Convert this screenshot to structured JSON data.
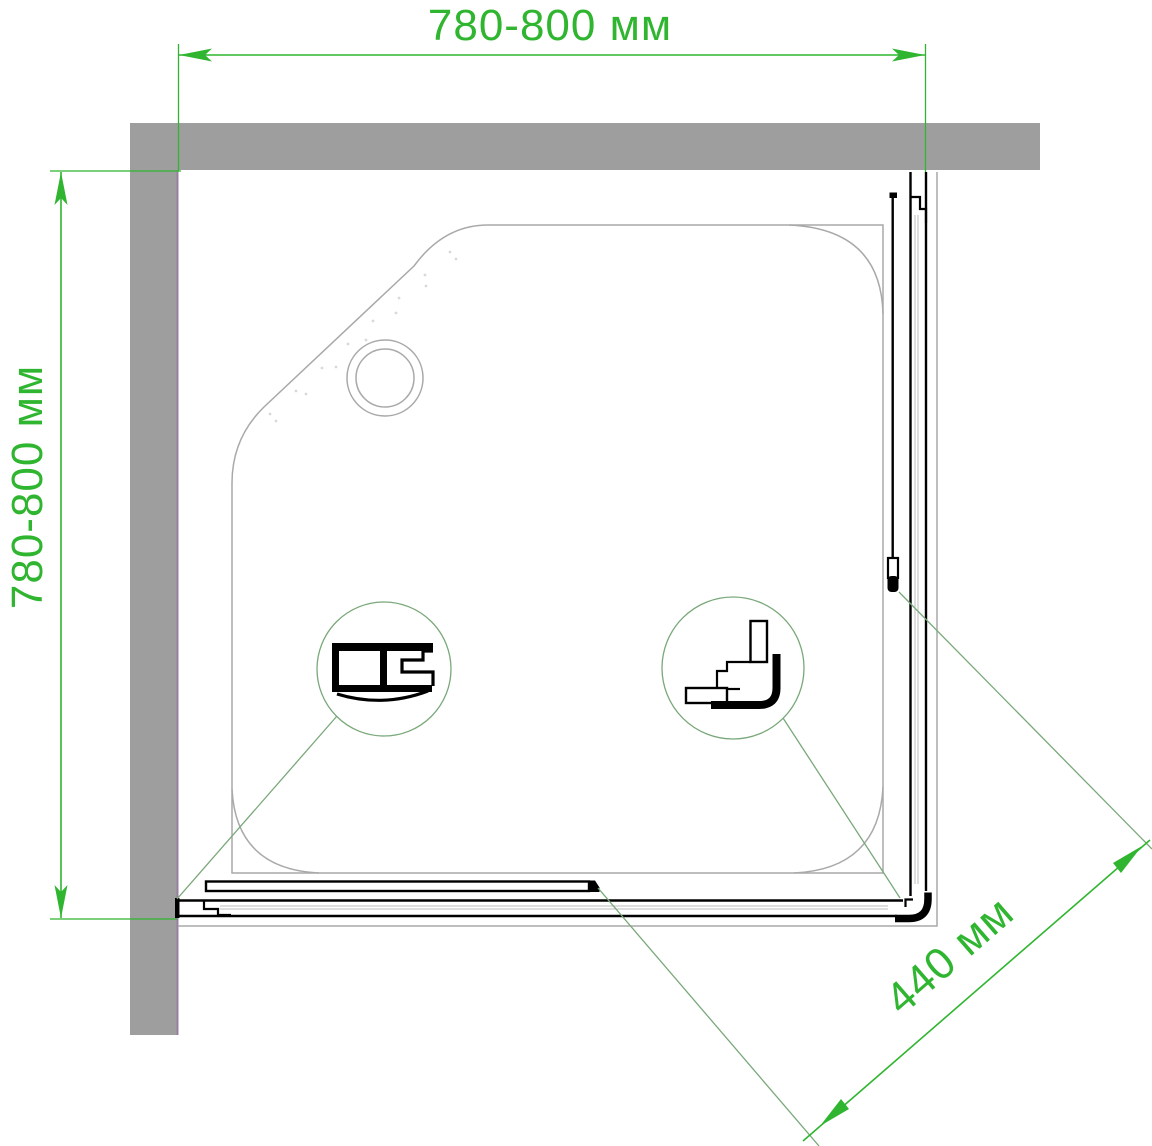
{
  "diagram": {
    "dimensions": {
      "width_top": "780-800 мм",
      "depth_left": "780-800 мм",
      "entry_diagonal": "440 мм"
    },
    "colors": {
      "dimension_green": "#2fb52f",
      "leader_green": "#79a879",
      "wall_gray": "#9e9e9e",
      "outline_gray": "#a9a9a9",
      "track_gray": "#bdbdbd",
      "wall_edge_purple": "#97809f",
      "profile_black": "#000000"
    }
  }
}
